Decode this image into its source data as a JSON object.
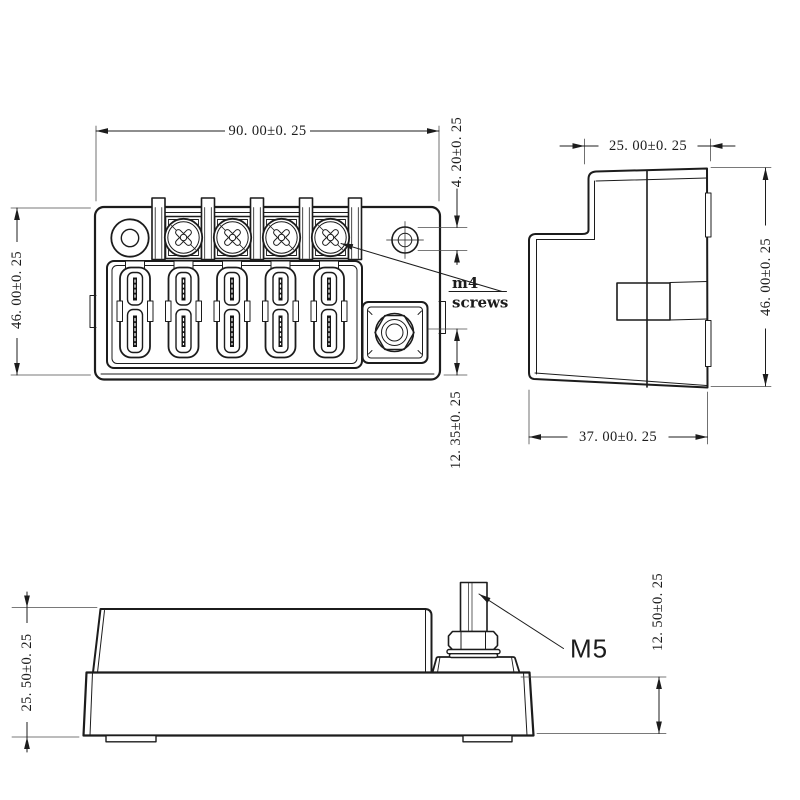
{
  "drawing": {
    "colors": {
      "background": "#ffffff",
      "line": "#1c1c1c",
      "ext_line": "#4d4d4d",
      "text": "#1c1c1c"
    },
    "dimensions": {
      "front_width": "90. 00±0. 25",
      "front_height": "46. 00±0. 25",
      "screw_hole_diameter": "4. 20±0. 25",
      "stud_to_bottom": "12. 35±0. 25",
      "side_top_width": "25. 00±0. 25",
      "side_height": "46. 00±0. 25",
      "side_bottom_width": "37. 00±0. 25",
      "profile_height": "25. 50±0. 25",
      "base_height": "12. 50±0. 25"
    },
    "labels": {
      "screw_note_line1": "m4",
      "screw_note_line2": "screws",
      "stud_thread": "M5"
    }
  }
}
